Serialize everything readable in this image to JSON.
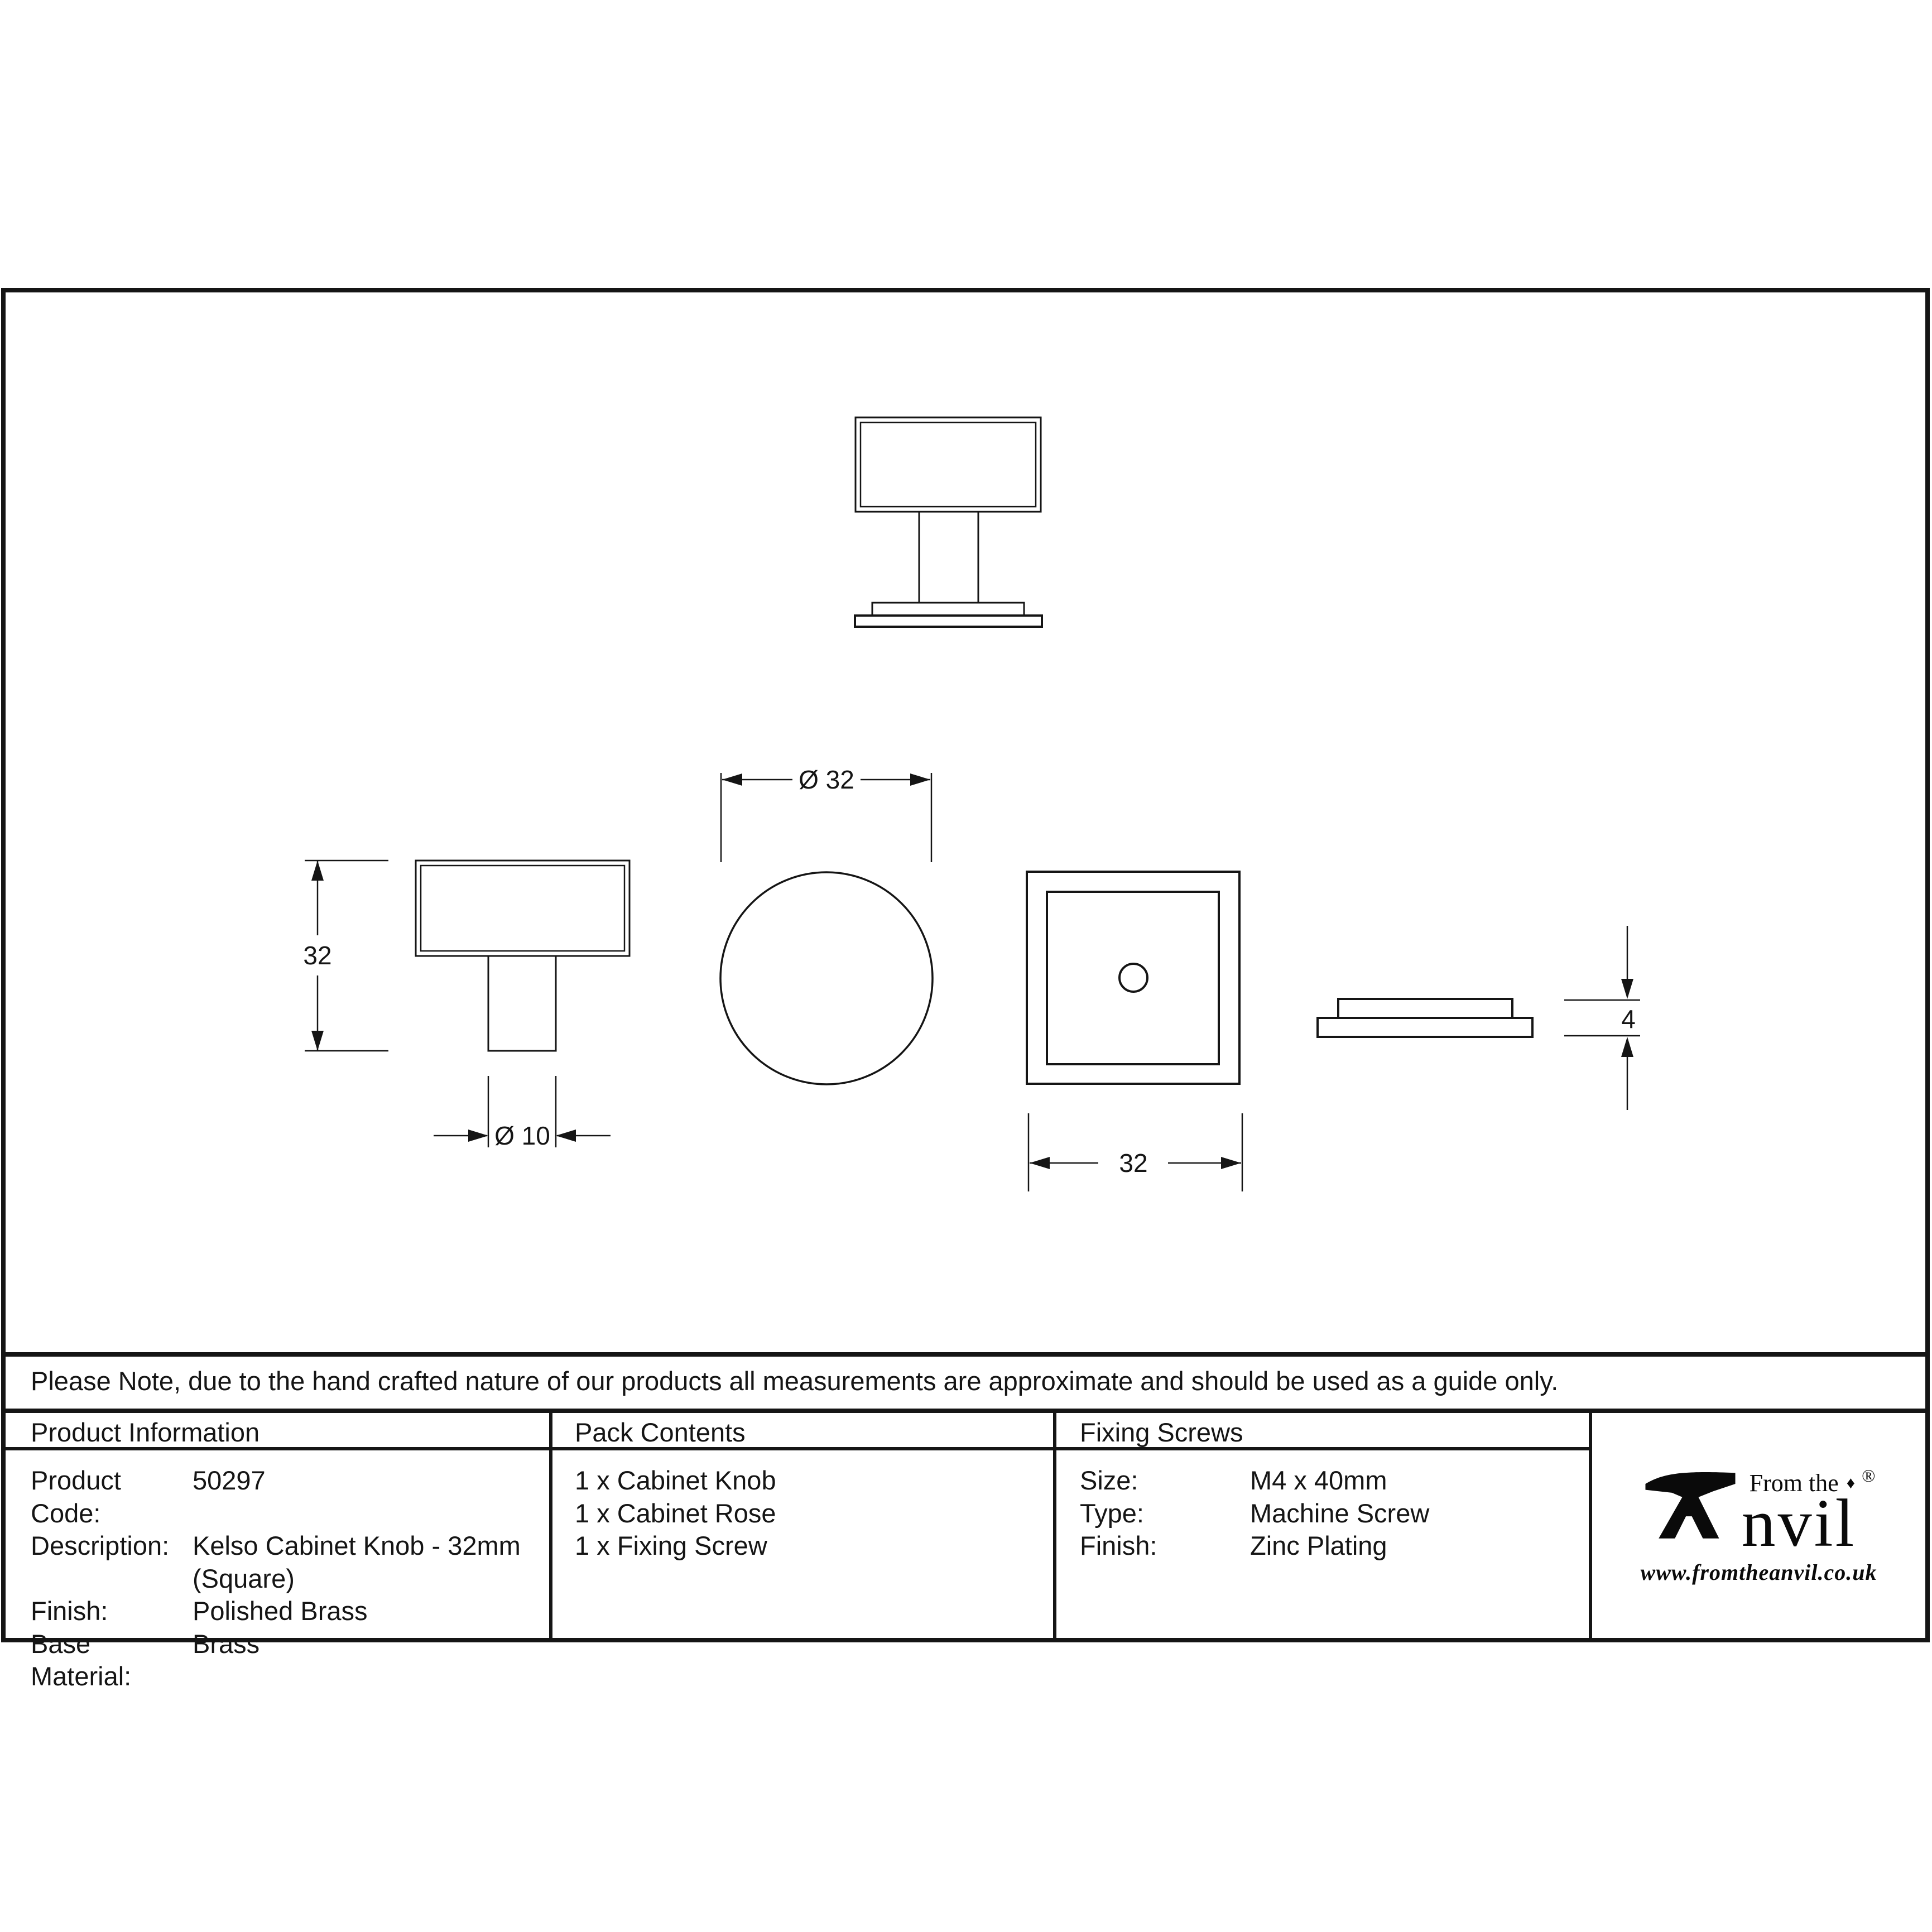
{
  "note": "Please Note, due to the hand crafted nature of our products all measurements are approximate and should be used as a guide only.",
  "dimensions": {
    "knob_height": "32",
    "stem_diameter": "Ø 10",
    "rose_diameter": "Ø 32",
    "square_size": "32",
    "rose_thickness": "4"
  },
  "table": {
    "product_information": {
      "title": "Product Information",
      "rows": [
        {
          "label": "Product Code:",
          "value": "50297"
        },
        {
          "label": "Description:",
          "value": "Kelso Cabinet Knob - 32mm"
        },
        {
          "label": "",
          "value": "(Square)"
        },
        {
          "label": "Finish:",
          "value": "Polished Brass"
        },
        {
          "label": "Base Material:",
          "value": "Brass"
        }
      ]
    },
    "pack_contents": {
      "title": "Pack Contents",
      "items": [
        "1 x Cabinet Knob",
        "1 x Cabinet Rose",
        "1 x Fixing Screw"
      ]
    },
    "fixing_screws": {
      "title": "Fixing Screws",
      "rows": [
        {
          "label": "Size:",
          "value": "M4 x 40mm"
        },
        {
          "label": "Type:",
          "value": "Machine Screw"
        },
        {
          "label": "Finish:",
          "value": "Zinc Plating"
        }
      ]
    }
  },
  "logo": {
    "prefix": "From the",
    "diamond": "♦",
    "name_rest": "nvil",
    "registered": "®",
    "url": "www.fromtheanvil.co.uk"
  },
  "colors": {
    "line": "#151515",
    "background": "#ffffff"
  }
}
